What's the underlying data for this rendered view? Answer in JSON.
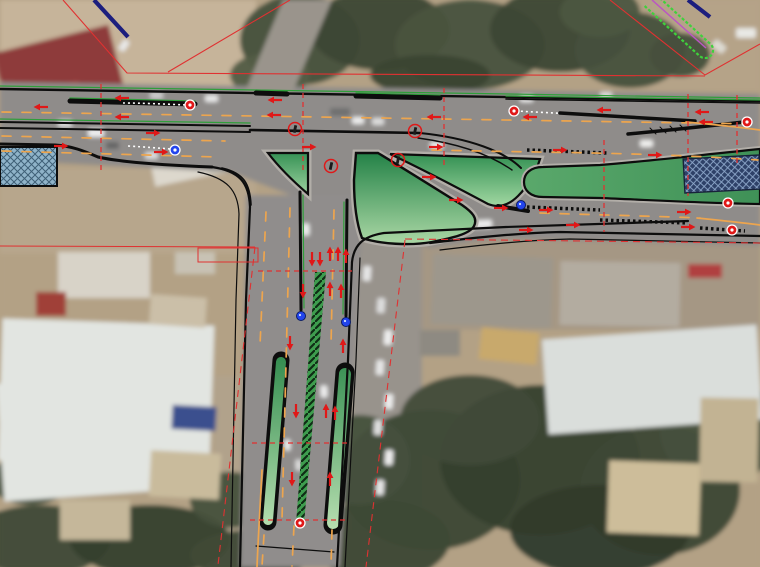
{
  "scene": {
    "kind": "road-design-plan-over-aerial-photo",
    "junction": "T-intersection, east-west dual carriageway with south stem",
    "features": [
      "channelization-islands",
      "raised-medians",
      "slip-lane",
      "lane-arrows",
      "station-ticks",
      "right-of-way-lines",
      "hatched-structures",
      "vegetation",
      "buildings",
      "vehicles"
    ]
  },
  "colors": {
    "dirt": "#b3a185",
    "dirt_light": "#c6b49a",
    "dirt_mid": "#b7a68c",
    "dirt_right": "#a59784",
    "asphalt": "#8f8c8a",
    "asphalt_dark": "#86827f",
    "band_gray": "#b2aea8",
    "trees": "#46503c",
    "trees_dark": "#353f2e",
    "trees_light": "#55604a",
    "roof_white": "#e2e5e1",
    "roof_gray": "#c6cac8",
    "roof_red": "#8e3a3a",
    "roof_blue": "#3a4f8e",
    "roof_tan": "#c9b894",
    "cad_black": "#0d0d0d",
    "cad_green": "#2f9e3a",
    "bright_green": "#3fd13c",
    "magenta": "#bb55c4",
    "lane_orange": "#eda54e",
    "accent_red": "#e03131",
    "marker_red": "#e01818",
    "marker_blue": "#2244ee",
    "navy": "#1c1e7e",
    "island_dark": "#1f7f44",
    "island_light": "#bbe2b0",
    "median_green_a": "#5aa86b",
    "median_green_b": "#3f9157",
    "hatch_blue_bg": "#8fb3c9",
    "hatch_blue_ln": "#3f6077",
    "hatch_navy_bg": "#2e4168",
    "hatch_navy_ln": "#8fa9cc"
  },
  "markers": {
    "arrows_left": [
      [
        123,
        98
      ],
      [
        42,
        107
      ],
      [
        123,
        117
      ],
      [
        276,
        100
      ],
      [
        275,
        115
      ],
      [
        435,
        117
      ],
      [
        531,
        117
      ],
      [
        605,
        110
      ],
      [
        703,
        112
      ],
      [
        707,
        122
      ]
    ],
    "arrows_right": [
      [
        152,
        133
      ],
      [
        60,
        146
      ],
      [
        160,
        152
      ],
      [
        308,
        147
      ],
      [
        435,
        147
      ],
      [
        559,
        150
      ],
      [
        654,
        155
      ],
      [
        545,
        210
      ],
      [
        683,
        212
      ],
      [
        687,
        227
      ],
      [
        455,
        200
      ],
      [
        500,
        208
      ],
      [
        525,
        230
      ],
      [
        572,
        225
      ],
      [
        428,
        177
      ]
    ],
    "arrows_up": [
      [
        330,
        255
      ],
      [
        338,
        255
      ],
      [
        346,
        257
      ],
      [
        330,
        290
      ],
      [
        341,
        292
      ],
      [
        343,
        347
      ],
      [
        326,
        412
      ],
      [
        335,
        414
      ],
      [
        330,
        480
      ]
    ],
    "arrows_down": [
      [
        312,
        258
      ],
      [
        320,
        258
      ],
      [
        303,
        290
      ],
      [
        290,
        342
      ],
      [
        296,
        410
      ],
      [
        292,
        478
      ]
    ],
    "red_badges": [
      [
        190,
        105
      ],
      [
        514,
        111
      ],
      [
        747,
        122
      ],
      [
        728,
        203
      ],
      [
        732,
        230
      ],
      [
        300,
        523
      ]
    ],
    "blue_badges": [
      [
        175,
        150
      ]
    ],
    "blue_dots": [
      [
        301,
        316
      ],
      [
        346,
        322
      ],
      [
        521,
        205
      ]
    ],
    "signal_circles": [
      [
        295,
        129
      ],
      [
        415,
        131
      ],
      [
        398,
        160
      ],
      [
        331,
        166
      ]
    ],
    "ticks_v": [
      {
        "x": 101,
        "y1": 84,
        "y2": 170
      },
      {
        "x": 303,
        "y1": 84,
        "y2": 172
      },
      {
        "x": 444,
        "y1": 88,
        "y2": 168
      },
      {
        "x": 604,
        "y1": 140,
        "y2": 232
      },
      {
        "x": 688,
        "y1": 94,
        "y2": 196
      },
      {
        "x": 737,
        "y1": 95,
        "y2": 163
      }
    ],
    "ticks_h": [
      {
        "y": 271,
        "x1": 258,
        "x2": 352
      },
      {
        "y": 443,
        "x1": 252,
        "x2": 350
      },
      {
        "y": 520,
        "x1": 250,
        "x2": 348
      }
    ]
  },
  "vehicles": [
    [
      58,
      120,
      14,
      7,
      0,
      "#dddddd"
    ],
    [
      150,
      92,
      13,
      7,
      0,
      "#cccccc"
    ],
    [
      205,
      95,
      13,
      7,
      0,
      "#e8e8e8"
    ],
    [
      330,
      108,
      20,
      8,
      0,
      "#6f6f6f"
    ],
    [
      352,
      117,
      12,
      7,
      0,
      "#ededed"
    ],
    [
      372,
      118,
      12,
      7,
      0,
      "#dddddd"
    ],
    [
      520,
      95,
      13,
      7,
      0,
      "#ededed"
    ],
    [
      600,
      92,
      12,
      6,
      0,
      "#dddddd"
    ],
    [
      640,
      140,
      13,
      7,
      0,
      "#f0f0ee"
    ],
    [
      88,
      129,
      16,
      8,
      0,
      "#eeeeee"
    ],
    [
      106,
      142,
      13,
      7,
      0,
      "#666666"
    ],
    [
      145,
      152,
      13,
      7,
      0,
      "#dddddd"
    ],
    [
      430,
      142,
      13,
      7,
      0,
      "#ededed"
    ],
    [
      470,
      220,
      22,
      8,
      -2,
      "#ececec"
    ],
    [
      118,
      42,
      12,
      7,
      -55,
      "#e8e8e8"
    ],
    [
      300,
      226,
      12,
      7,
      88,
      "#ededed"
    ],
    [
      318,
      388,
      12,
      7,
      88,
      "#ededed"
    ],
    [
      282,
      442,
      11,
      6,
      88,
      "#ededed"
    ],
    [
      293,
      462,
      11,
      6,
      88,
      "#dddddd"
    ],
    [
      363,
      266,
      8,
      15,
      4,
      "#e6e6e6"
    ],
    [
      377,
      298,
      8,
      15,
      4,
      "#dddddd"
    ],
    [
      384,
      330,
      8,
      15,
      4,
      "#eeeeee"
    ],
    [
      376,
      360,
      8,
      15,
      4,
      "#e6e6e6"
    ],
    [
      385,
      394,
      8,
      15,
      4,
      "#ededed"
    ],
    [
      374,
      420,
      8,
      15,
      4,
      "#e0e0e0"
    ],
    [
      385,
      450,
      8,
      15,
      4,
      "#eeeeee"
    ],
    [
      376,
      480,
      8,
      15,
      4,
      "#e6e6e6"
    ],
    [
      736,
      28,
      20,
      10,
      0,
      "#e8e8e4"
    ],
    [
      712,
      42,
      14,
      9,
      40,
      "#dddad2"
    ]
  ],
  "buildings": [
    [
      0,
      38,
      118,
      66,
      -14,
      "#8e3a3a"
    ],
    [
      14,
      88,
      70,
      42,
      -14,
      "#9e4442"
    ],
    [
      148,
      116,
      110,
      60,
      -12,
      "#ddd8cd"
    ],
    [
      206,
      146,
      42,
      26,
      -12,
      "#cfcabe"
    ],
    [
      0,
      322,
      212,
      142,
      2,
      "#e2e5e1"
    ],
    [
      58,
      252,
      92,
      46,
      0,
      "#d8d3c8"
    ],
    [
      150,
      296,
      56,
      30,
      4,
      "#cbbfa8"
    ],
    [
      36,
      292,
      30,
      24,
      0,
      "#a04038"
    ],
    [
      175,
      252,
      40,
      22,
      0,
      "#c8c2b4"
    ],
    [
      0,
      378,
      162,
      118,
      -4,
      "#e2e5e1"
    ],
    [
      150,
      452,
      70,
      46,
      3,
      "#c9bb9c"
    ],
    [
      172,
      406,
      44,
      24,
      3,
      "#3a4f8e"
    ],
    [
      60,
      500,
      70,
      40,
      0,
      "#c5b79a"
    ],
    [
      432,
      256,
      120,
      70,
      2,
      "#9d978c"
    ],
    [
      560,
      262,
      120,
      64,
      1,
      "#b3aca0"
    ],
    [
      545,
      332,
      215,
      95,
      -4,
      "#dadedb"
    ],
    [
      688,
      264,
      34,
      14,
      0,
      "#b04040"
    ],
    [
      608,
      462,
      92,
      72,
      2,
      "#cdbd9a"
    ],
    [
      700,
      398,
      58,
      84,
      1,
      "#c2b393"
    ],
    [
      480,
      330,
      58,
      32,
      6,
      "#c8a96c"
    ],
    [
      420,
      330,
      40,
      26,
      0,
      "#8e8a82"
    ]
  ],
  "tree_patches": [
    [
      300,
      40,
      60,
      45,
      "#46503c"
    ],
    [
      380,
      30,
      70,
      40,
      "#3d4734"
    ],
    [
      470,
      45,
      75,
      45,
      "#49523e"
    ],
    [
      560,
      30,
      70,
      42,
      "#3d4734"
    ],
    [
      630,
      50,
      55,
      38,
      "#46503c"
    ],
    [
      270,
      75,
      40,
      22,
      "#535d45"
    ],
    [
      430,
      75,
      60,
      20,
      "#3a4432"
    ],
    [
      600,
      12,
      40,
      25,
      "#4c5640"
    ],
    [
      680,
      55,
      30,
      22,
      "#46503c"
    ],
    [
      430,
      480,
      90,
      70,
      "#3c4835"
    ],
    [
      540,
      460,
      100,
      75,
      "#353f2e"
    ],
    [
      660,
      490,
      80,
      65,
      "#3c4835"
    ],
    [
      720,
      430,
      60,
      55,
      "#46503c"
    ],
    [
      470,
      420,
      70,
      45,
      "#414b38"
    ],
    [
      600,
      530,
      90,
      45,
      "#2f3a2b"
    ],
    [
      380,
      540,
      70,
      40,
      "#3c4835"
    ],
    [
      360,
      460,
      50,
      45,
      "#46503c"
    ],
    [
      40,
      540,
      70,
      35,
      "#3f4936"
    ],
    [
      150,
      540,
      80,
      35,
      "#353f2e"
    ],
    [
      250,
      555,
      60,
      25,
      "#3f4936"
    ],
    [
      30,
      480,
      40,
      25,
      "#4a5540"
    ],
    [
      230,
      500,
      40,
      28,
      "#46503c"
    ]
  ]
}
